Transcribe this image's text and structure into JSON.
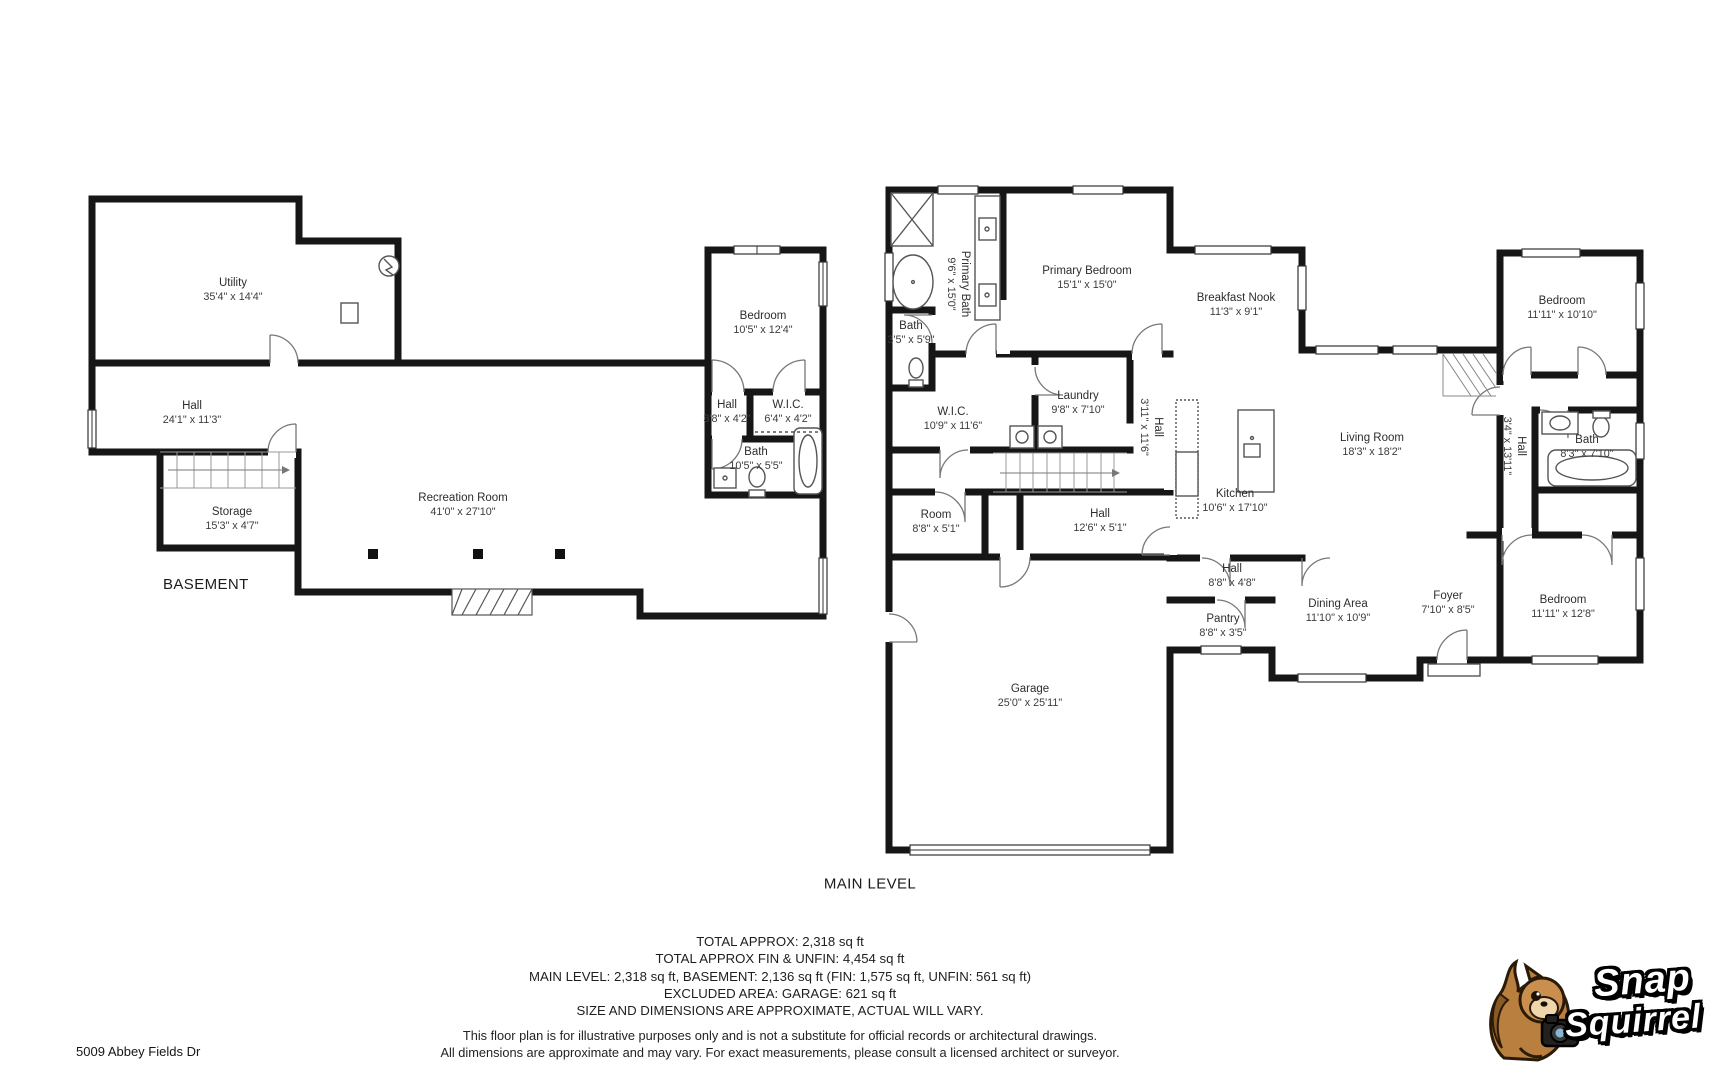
{
  "address": "5009 Abbey Fields Dr",
  "levels": {
    "basement": {
      "label": "BASEMENT",
      "rooms": [
        {
          "name": "Utility",
          "dims": "35'4\" x 14'4\""
        },
        {
          "name": "Hall",
          "dims": "24'1\" x 11'3\""
        },
        {
          "name": "Storage",
          "dims": "15'3\" x 4'7\""
        },
        {
          "name": "Recreation Room",
          "dims": "41'0\" x 27'10\""
        },
        {
          "name": "Bedroom",
          "dims": "10'5\" x 12'4\""
        },
        {
          "name": "Hall",
          "dims": "3'8\" x 4'2\""
        },
        {
          "name": "W.I.C.",
          "dims": "6'4\" x 4'2\""
        },
        {
          "name": "Bath",
          "dims": "10'5\" x 5'5\""
        }
      ]
    },
    "main": {
      "label": "MAIN LEVEL",
      "rooms": [
        {
          "name": "Primary Bath",
          "dims": "9'6\" x 15'0\""
        },
        {
          "name": "Primary Bedroom",
          "dims": "15'1\" x 15'0\""
        },
        {
          "name": "Bath",
          "dims": "3'5\" x 5'9\""
        },
        {
          "name": "W.I.C.",
          "dims": "10'9\" x 11'6\""
        },
        {
          "name": "Laundry",
          "dims": "9'8\" x 7'10\""
        },
        {
          "name": "Hall",
          "dims": "3'11\" x 11'6\""
        },
        {
          "name": "Breakfast Nook",
          "dims": "11'3\" x 9'1\""
        },
        {
          "name": "Living Room",
          "dims": "18'3\" x 18'2\""
        },
        {
          "name": "Kitchen",
          "dims": "10'6\" x 17'10\""
        },
        {
          "name": "Room",
          "dims": "8'8\" x 5'1\""
        },
        {
          "name": "Hall",
          "dims": "12'6\" x 5'1\""
        },
        {
          "name": "Hall",
          "dims": "8'8\" x 4'8\""
        },
        {
          "name": "Pantry",
          "dims": "8'8\" x 3'5\""
        },
        {
          "name": "Dining Area",
          "dims": "11'10\" x 10'9\""
        },
        {
          "name": "Foyer",
          "dims": "7'10\" x 8'5\""
        },
        {
          "name": "Garage",
          "dims": "25'0\" x 25'11\""
        },
        {
          "name": "Bedroom",
          "dims": "11'11\" x 10'10\""
        },
        {
          "name": "Bath",
          "dims": "8'3\" x 7'10\""
        },
        {
          "name": "Hall",
          "dims": "3'4\" x 13'11\""
        },
        {
          "name": "Bedroom",
          "dims": "11'11\" x 12'8\""
        }
      ]
    }
  },
  "summary": {
    "line1": "TOTAL APPROX: 2,318 sq ft",
    "line2": "TOTAL APPROX FIN & UNFIN: 4,454 sq ft",
    "line3": "MAIN LEVEL: 2,318 sq ft, BASEMENT: 2,136 sq ft (FIN: 1,575 sq ft, UNFIN: 561 sq ft)",
    "line4": "EXCLUDED AREA: GARAGE: 621 sq ft",
    "line5": "SIZE AND DIMENSIONS ARE APPROXIMATE, ACTUAL WILL VARY."
  },
  "disclaimer": {
    "line1": "This floor plan is for illustrative purposes only and is not a substitute for official records or architectural drawings.",
    "line2": "All dimensions are approximate and may vary. For exact measurements, please consult a licensed architect or surveyor."
  },
  "logo": {
    "word1": "Snap",
    "word2": "Squirrel"
  },
  "colors": {
    "wall": "#161616",
    "fixture": "#555555",
    "door": "#777777",
    "window_edge": "#333333",
    "text": "#2d2d2d",
    "logo_squirrel": "#b97f3e",
    "logo_text": "#ffffff"
  },
  "icons": {
    "shower-icon": "x-box",
    "bathtub-icon": "rounded-rect-oval",
    "toilet-icon": "ellipse-tank",
    "sink-icon": "square-dot",
    "stairs-icon": "tread-lines",
    "door-icon": "quarter-arc",
    "window-icon": "double-line",
    "water-heater-icon": "circle-zigzag",
    "support-post-icon": "filled-square",
    "washer-dryer-icon": "square-circle",
    "kitchen-island-icon": "rect-sink",
    "camera-icon": "camera"
  }
}
